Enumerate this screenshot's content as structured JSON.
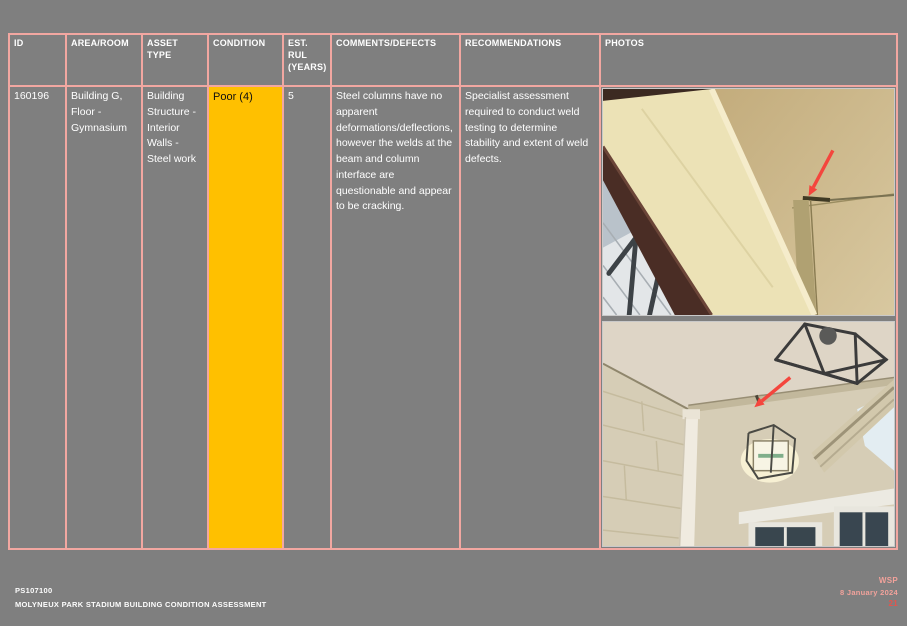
{
  "table": {
    "headers": [
      "ID",
      "AREA/ROOM",
      "ASSET TYPE",
      "CONDITION",
      "EST. RUL (YEARS)",
      "COMMENTS/DEFECTS",
      "RECOMMENDATIONS",
      "PHOTOS"
    ],
    "row": {
      "id": "160196",
      "area_room": "Building G, Floor - Gymnasium",
      "asset_type": "Building Structure - Interior Walls - Steel work",
      "condition": "Poor (4)",
      "condition_color": "#FFC000",
      "est_rul_years": "5",
      "comments_defects": "Steel columns have no apparent deformations/deflections, however the welds at the beam and column interface are questionable and appear to be cracking.",
      "recommendations": "Specialist assessment required to conduct weld testing to determine stability and extent of weld defects.",
      "photos": [
        {
          "name": "gymnasium-beam-column-weld-photo"
        },
        {
          "name": "gymnasium-ceiling-wall-joint-photo"
        }
      ]
    }
  },
  "footer": {
    "project_number": "PS107100",
    "report_title": "MOLYNEUX PARK STADIUM BUILDING CONDITION ASSESSMENT",
    "company": "WSP",
    "date": "8 January 2024",
    "page_number": "21"
  },
  "colors": {
    "page_background": "#7f7f7f",
    "table_border": "#f2a7a1",
    "condition_poor_fill": "#FFC000",
    "footer_accent": "#f2a29b",
    "page_number_red": "#e4544c",
    "defect_arrow_red": "#f4463d"
  }
}
